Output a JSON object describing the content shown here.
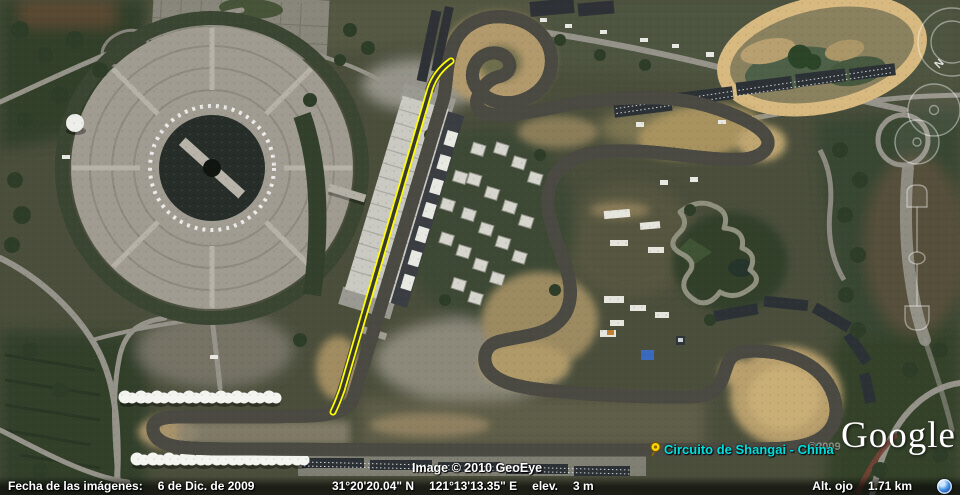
{
  "navigation": {
    "north_label": "N"
  },
  "placemark": {
    "label": "Circuito de Shangai - China"
  },
  "watermarks": {
    "imagery_attribution": "Image © 2010 GeoEye",
    "logo": "Google",
    "ghost_year": "©2009"
  },
  "status_bar": {
    "imagery_date_label": "Fecha de las imágenes:",
    "imagery_date_value": "6 de Dic. de 2009",
    "latitude": "31°20'20.04\" N",
    "longitude": "121°13'13.35\" E",
    "elevation_label": "elev.",
    "elevation_value": "3 m",
    "eye_altitude_label": "Alt. ojo",
    "eye_altitude_value": "1.71 km"
  }
}
